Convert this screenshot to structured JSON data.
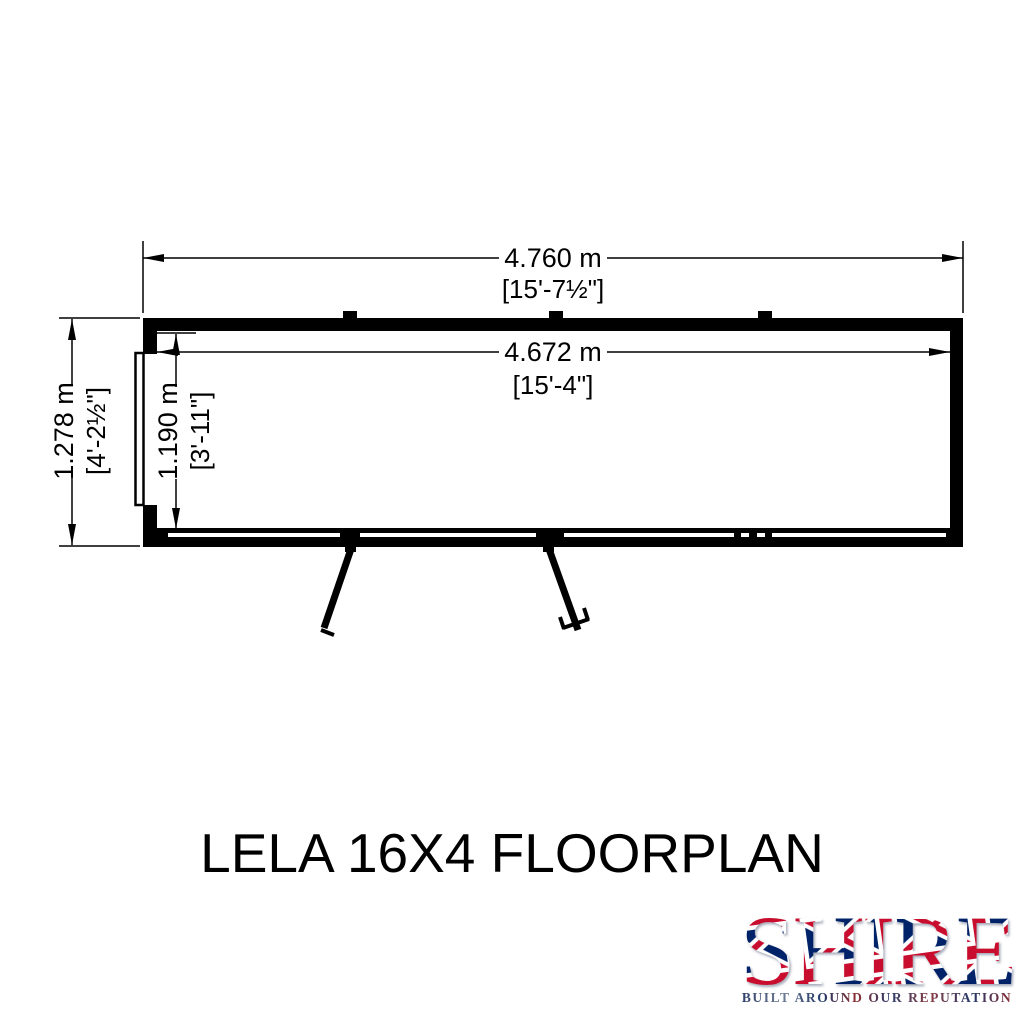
{
  "page": {
    "background_color": "#ffffff",
    "drawing_color": "#000000"
  },
  "title": "LELA 16X4 FLOORPLAN",
  "floorplan": {
    "view": "top-down shed floorplan with double front doors and left end door",
    "dimensions": {
      "outer_width": {
        "metric": "4.760 m",
        "imperial": "[15'-7½\"]"
      },
      "inner_width": {
        "metric": "4.672 m",
        "imperial": "[15'-4\"]"
      },
      "outer_depth": {
        "metric": "1.278 m",
        "imperial": "[4'-2½\"]"
      },
      "inner_depth": {
        "metric": "1.190 m",
        "imperial": "[3'-11\"]"
      }
    }
  },
  "logo": {
    "brand": "SHIRE",
    "tagline": "BUILT AROUND OUR REPUTATION",
    "colors": {
      "flag_blue": "#012169",
      "flag_red": "#C8102E",
      "flag_white": "#ffffff"
    }
  }
}
